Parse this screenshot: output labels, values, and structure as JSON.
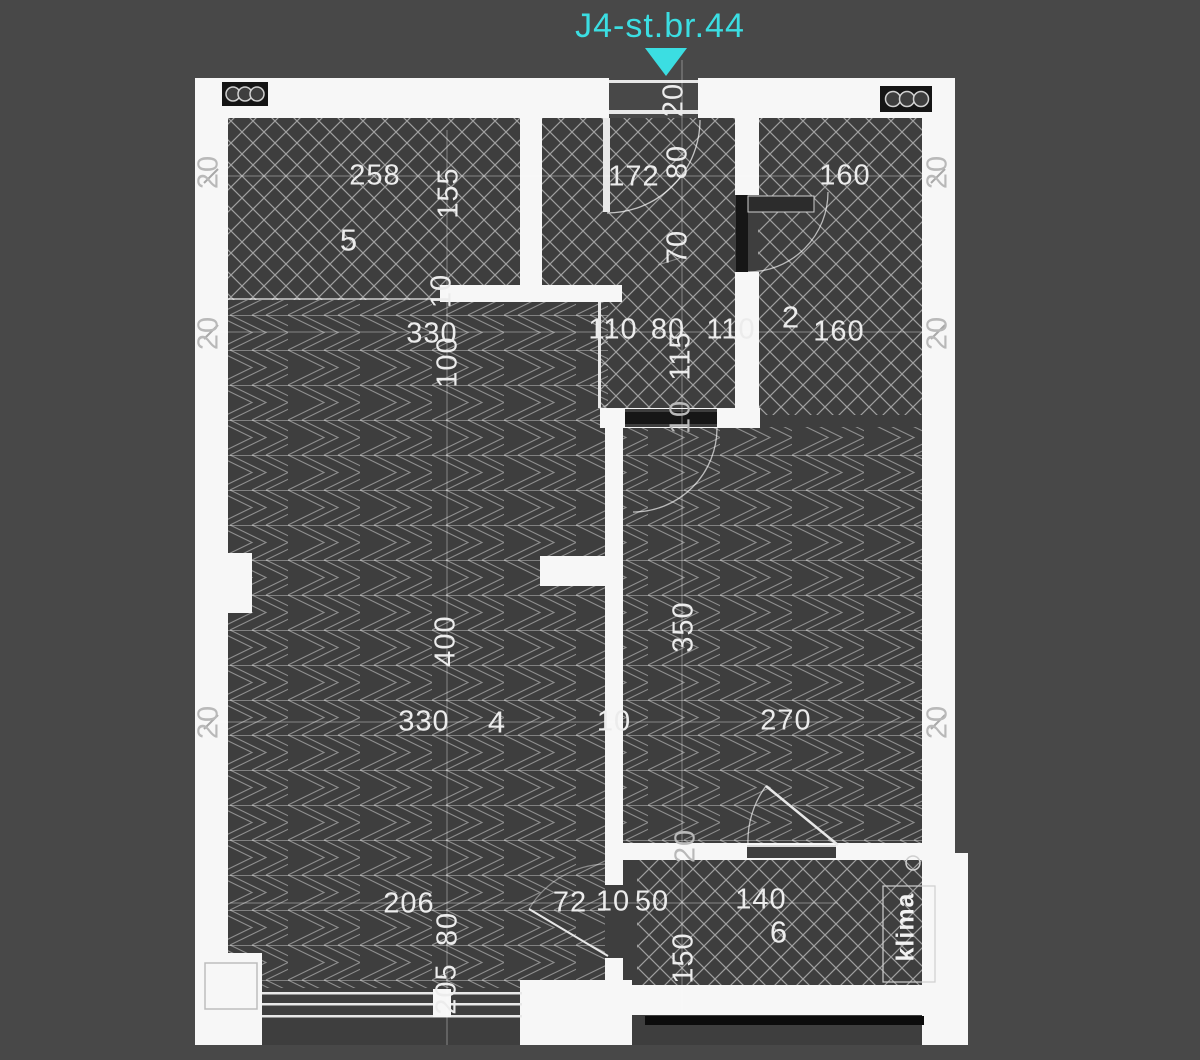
{
  "title": {
    "text": "J4-st.br.44",
    "color": "#3BDEE2"
  },
  "colors": {
    "background": "#484848",
    "floor": "#3e3e3e",
    "wall": "#f7f7f7",
    "accent_cyan": "#3BDEE2",
    "hatch_line": "#ffffff",
    "railing": "#0c0c0c"
  },
  "rooms": [
    {
      "number": "5",
      "width": "258",
      "height": "155"
    },
    {
      "number": "2",
      "width": "160",
      "width2": "160"
    },
    {
      "number": "4",
      "width": "330",
      "height": "400",
      "bottom_width": "330",
      "window_width": "206",
      "window_height": "205"
    },
    {
      "number": "3",
      "width": "270",
      "height": "350"
    },
    {
      "number": "6",
      "width": "140",
      "height": "150"
    }
  ],
  "labels": [
    {
      "kind": "title",
      "text": "J4-st.br.44"
    },
    {
      "kind": "dimension",
      "text": "20"
    },
    {
      "kind": "dimension",
      "text": "258"
    },
    {
      "kind": "room-number",
      "text": "5"
    },
    {
      "kind": "dimension",
      "text": "155"
    },
    {
      "kind": "dimension",
      "text": "10"
    },
    {
      "kind": "dimension",
      "text": "172"
    },
    {
      "kind": "dimension",
      "text": "80"
    },
    {
      "kind": "dimension",
      "text": "70"
    },
    {
      "kind": "dimension",
      "text": "160"
    },
    {
      "kind": "dimension",
      "text": "20"
    },
    {
      "kind": "dimension",
      "text": "20"
    },
    {
      "kind": "dimension",
      "text": "330"
    },
    {
      "kind": "dimension",
      "text": "100"
    },
    {
      "kind": "dimension",
      "text": "110"
    },
    {
      "kind": "dimension",
      "text": "80"
    },
    {
      "kind": "dimension",
      "text": "115"
    },
    {
      "kind": "dimension",
      "text": "110"
    },
    {
      "kind": "room-number",
      "text": "2"
    },
    {
      "kind": "dimension",
      "text": "160"
    },
    {
      "kind": "dimension",
      "text": "20"
    },
    {
      "kind": "dimension",
      "text": "20"
    },
    {
      "kind": "dimension",
      "text": "10"
    },
    {
      "kind": "dimension",
      "text": "400"
    },
    {
      "kind": "dimension",
      "text": "350"
    },
    {
      "kind": "dimension",
      "text": "330"
    },
    {
      "kind": "room-number",
      "text": "4"
    },
    {
      "kind": "dimension",
      "text": "10"
    },
    {
      "kind": "dimension",
      "text": "270"
    },
    {
      "kind": "dimension",
      "text": "20"
    },
    {
      "kind": "dimension",
      "text": "20"
    },
    {
      "kind": "dimension",
      "text": "206"
    },
    {
      "kind": "dimension",
      "text": "80"
    },
    {
      "kind": "dimension",
      "text": "205"
    },
    {
      "kind": "dimension",
      "text": "72"
    },
    {
      "kind": "dimension",
      "text": "10"
    },
    {
      "kind": "dimension",
      "text": "50"
    },
    {
      "kind": "dimension",
      "text": "20"
    },
    {
      "kind": "dimension",
      "text": "140"
    },
    {
      "kind": "room-number",
      "text": "6"
    },
    {
      "kind": "dimension",
      "text": "150"
    },
    {
      "kind": "annotation",
      "text": "klima"
    }
  ]
}
